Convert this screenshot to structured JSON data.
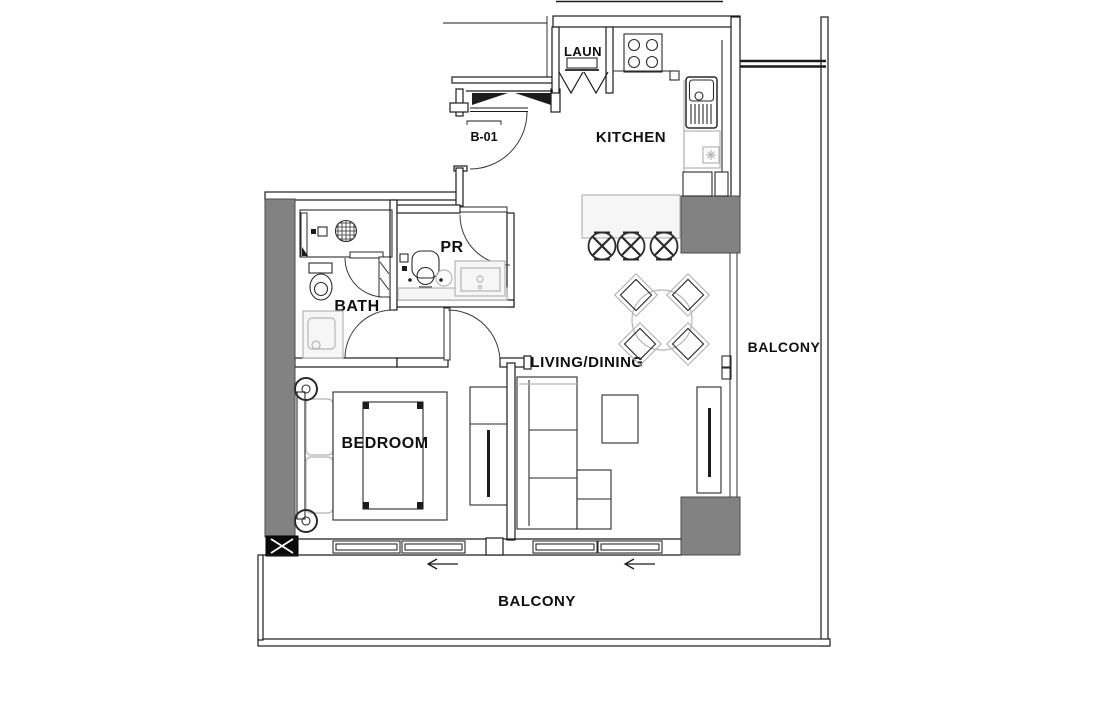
{
  "labels": {
    "unit": "B-01",
    "laundry": "LAUN",
    "kitchen": "KITCHEN",
    "powder_room": "PR",
    "bath": "BATH",
    "bedroom": "BEDROOM",
    "living_dining": "LIVING/DINING",
    "balcony_right": "BALCONY",
    "balcony_bottom": "BALCONY"
  },
  "colors": {
    "line": "#1c1c1c",
    "column": "#828282",
    "fixture": "#b5b5b5",
    "paper": "#ffffff"
  }
}
